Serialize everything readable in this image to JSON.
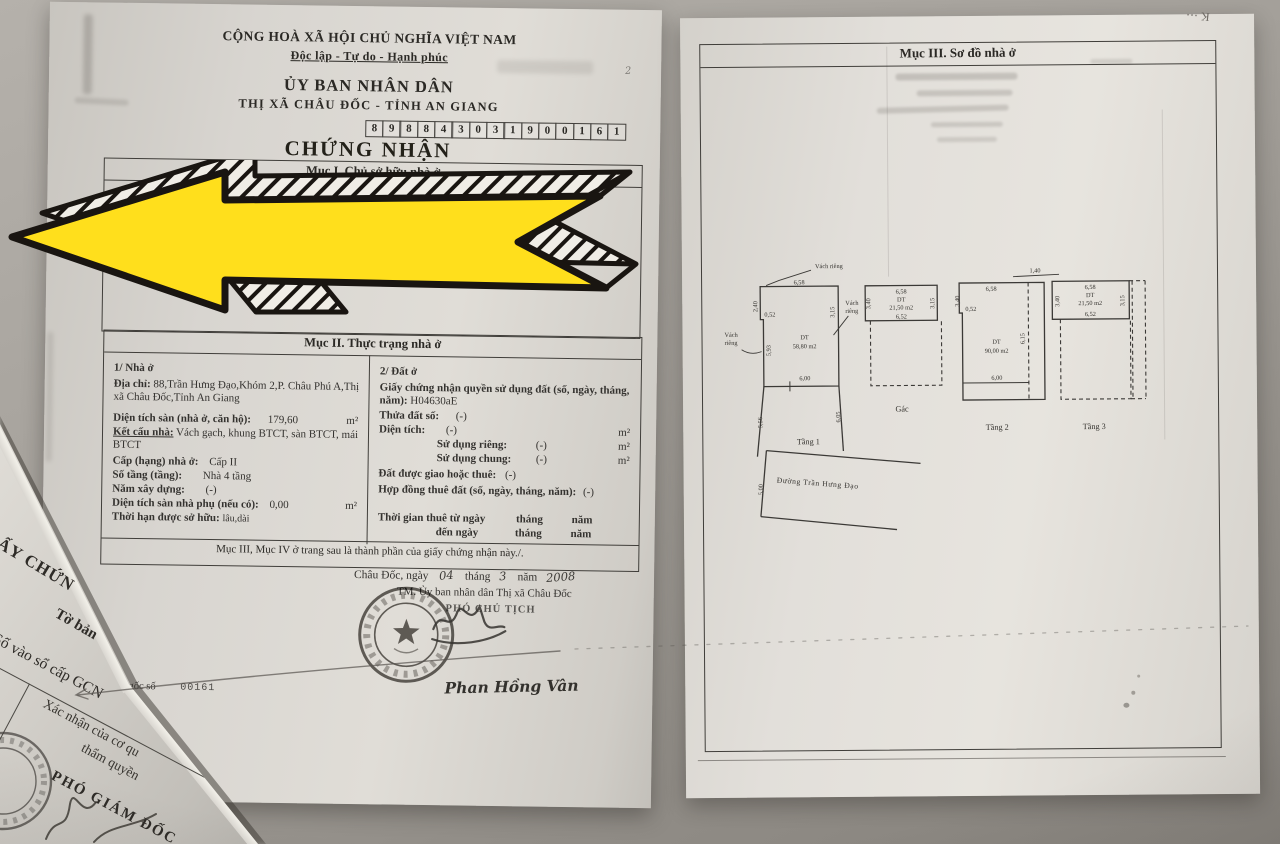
{
  "photo": {
    "background": "#a19d97",
    "paper_color": "#dad7d1",
    "ink": "#34322f",
    "arrow_yellow": "#ffdf1c",
    "arrow_outline": "#191511"
  },
  "page_left": {
    "header": {
      "national_title": "CỘNG HOÀ XÃ HỘI CHỦ NGHĨA VIỆT NAM",
      "motto": "Độc lập - Tự do - Hạnh phúc",
      "issuer_line1": "ỦY BAN NHÂN DÂN",
      "issuer_line2": "THỊ XÃ CHÂU ĐỐC - TỈNH AN GIANG",
      "serial_digits": [
        "8",
        "9",
        "8",
        "8",
        "4",
        "3",
        "0",
        "3",
        "1",
        "9",
        "0",
        "0",
        "1",
        "6",
        "1"
      ],
      "doc_title": "CHỨNG NHẬN",
      "margin_mark": "2"
    },
    "section1": {
      "title": "Mục I. Chủ sở hữu nhà ở",
      "hidden_fragment_1": "Giang",
      "hidden_fragment_2": "Giang"
    },
    "section2": {
      "title": "Mục II. Thực trạng nhà ở",
      "house": {
        "heading": "1/ Nhà ở",
        "address_label": "Địa chỉ:",
        "address_value": "88,Trần Hưng Đạo,Khóm 2,P. Châu Phú A,Thị xã Châu Đốc,Tỉnh An Giang",
        "floor_area_label": "Diện tích sàn (nhà ở, căn hộ):",
        "floor_area_value": "179,60",
        "floor_area_unit": "m²",
        "structure_label": "Kết cấu nhà:",
        "structure_value": "Vách gạch, khung BTCT, sàn BTCT, mái BTCT",
        "grade_label": "Cấp (hạng) nhà ở:",
        "grade_value": "Cấp II",
        "floors_label": "Số tầng (tầng):",
        "floors_value": "Nhà 4 tầng",
        "year_label": "Năm xây dựng:",
        "year_value": "(-)",
        "aux_area_label": "Diện tích sàn nhà phụ (nếu có):",
        "aux_area_value": "0,00",
        "aux_area_unit": "m²",
        "tenure_label": "Thời hạn được sở hữu:",
        "tenure_value": "lâu,dài"
      },
      "land": {
        "heading": "2/ Đất ở",
        "cert_label": "Giấy chứng nhận quyền sử dụng đất (số, ngày, tháng, năm):",
        "cert_value": "H04630aE",
        "parcel_label": "Thửa đất số:",
        "parcel_value": "(-)",
        "area_label": "Diện tích:",
        "area_value": "(-)",
        "unit_m2": "m²",
        "private_label": "Sử dụng riêng:",
        "private_value": "(-)",
        "shared_label": "Sử dụng chung:",
        "shared_value": "(-)",
        "alloc_label": "Đất được giao hoặc thuê:",
        "alloc_value": "(-)",
        "contract_label": "Hợp đồng thuê đất (số, ngày, tháng, năm):",
        "contract_value": "(-)",
        "lease_from_label": "Thời gian thuê từ ngày",
        "lease_to_label": "đến ngày",
        "month_label": "tháng",
        "year_label": "năm"
      },
      "footer_note": "Mục III, Mục IV ở trang sau là thành phần của giấy chứng nhận này./."
    },
    "signing": {
      "place_label": "Châu Đốc, ngày",
      "day_value": "04",
      "month_label": "tháng",
      "month_value": "3",
      "year_label": "năm",
      "year_value": "2008",
      "authority_line": "TM. Ủy ban nhân dân Thị xã Châu Đốc",
      "signer_title": "PHÓ CHỦ TỊCH",
      "signer_name": "Phan Hồng Vân"
    },
    "registry_note": {
      "prefix": "gốc số",
      "number": "00161"
    }
  },
  "page_right": {
    "title": "Mục III. Sơ đồ nhà ở",
    "floor_plans": {
      "wall_label": "Vách riêng",
      "wall_label_1": "Vách",
      "wall_label_2": "riêng",
      "tang1": {
        "label": "Tầng 1",
        "dt": "DT",
        "area": "58,80 m2",
        "dim_top": "6,58",
        "dim_notch_h": "2,40",
        "dim_notch_w": "0,52",
        "dim_left": "5,93",
        "dim_right": "3,15",
        "dim_width": "6,00",
        "dim_ext_left": "5,56",
        "dim_ext_right": "6,05"
      },
      "gac": {
        "label": "Gác",
        "dt": "DT",
        "area": "21,50 m2",
        "dim_top": "6,58",
        "dim_bottom": "6,52",
        "dim_left": "3,40",
        "dim_right": "3,15"
      },
      "tang2": {
        "label": "Tầng 2",
        "dt": "DT",
        "area": "90,00 m2",
        "dim_top": "6,58",
        "dim_over": "1,40",
        "dim_notch_h": "3,40",
        "dim_notch_w": "0,52",
        "dim_width": "6,00",
        "dim_right": "6,15"
      },
      "tang3": {
        "label": "Tầng 3",
        "dt": "DT",
        "area": "21,50 m2",
        "dim_top": "6,58",
        "dim_bottom": "6,52",
        "dim_left": "3,40",
        "dim_right": "3,15"
      },
      "street": {
        "name": "Đường Trần Hưng Đạo",
        "dim": "5,00"
      }
    }
  },
  "corner_paper": {
    "line_cert": "ẤY CHỨN",
    "line_to_ban": "Tờ bản",
    "line_so_vao": "Số vào sổ cấp GCN",
    "line_xacnhan": "Xác nhận của cơ qu",
    "line_tham_quyen": "thẩm quyền",
    "line_pho_gd": "PHÓ GIÁM ĐỐC"
  },
  "annotations": {
    "corner_mark": "K ⋯"
  }
}
